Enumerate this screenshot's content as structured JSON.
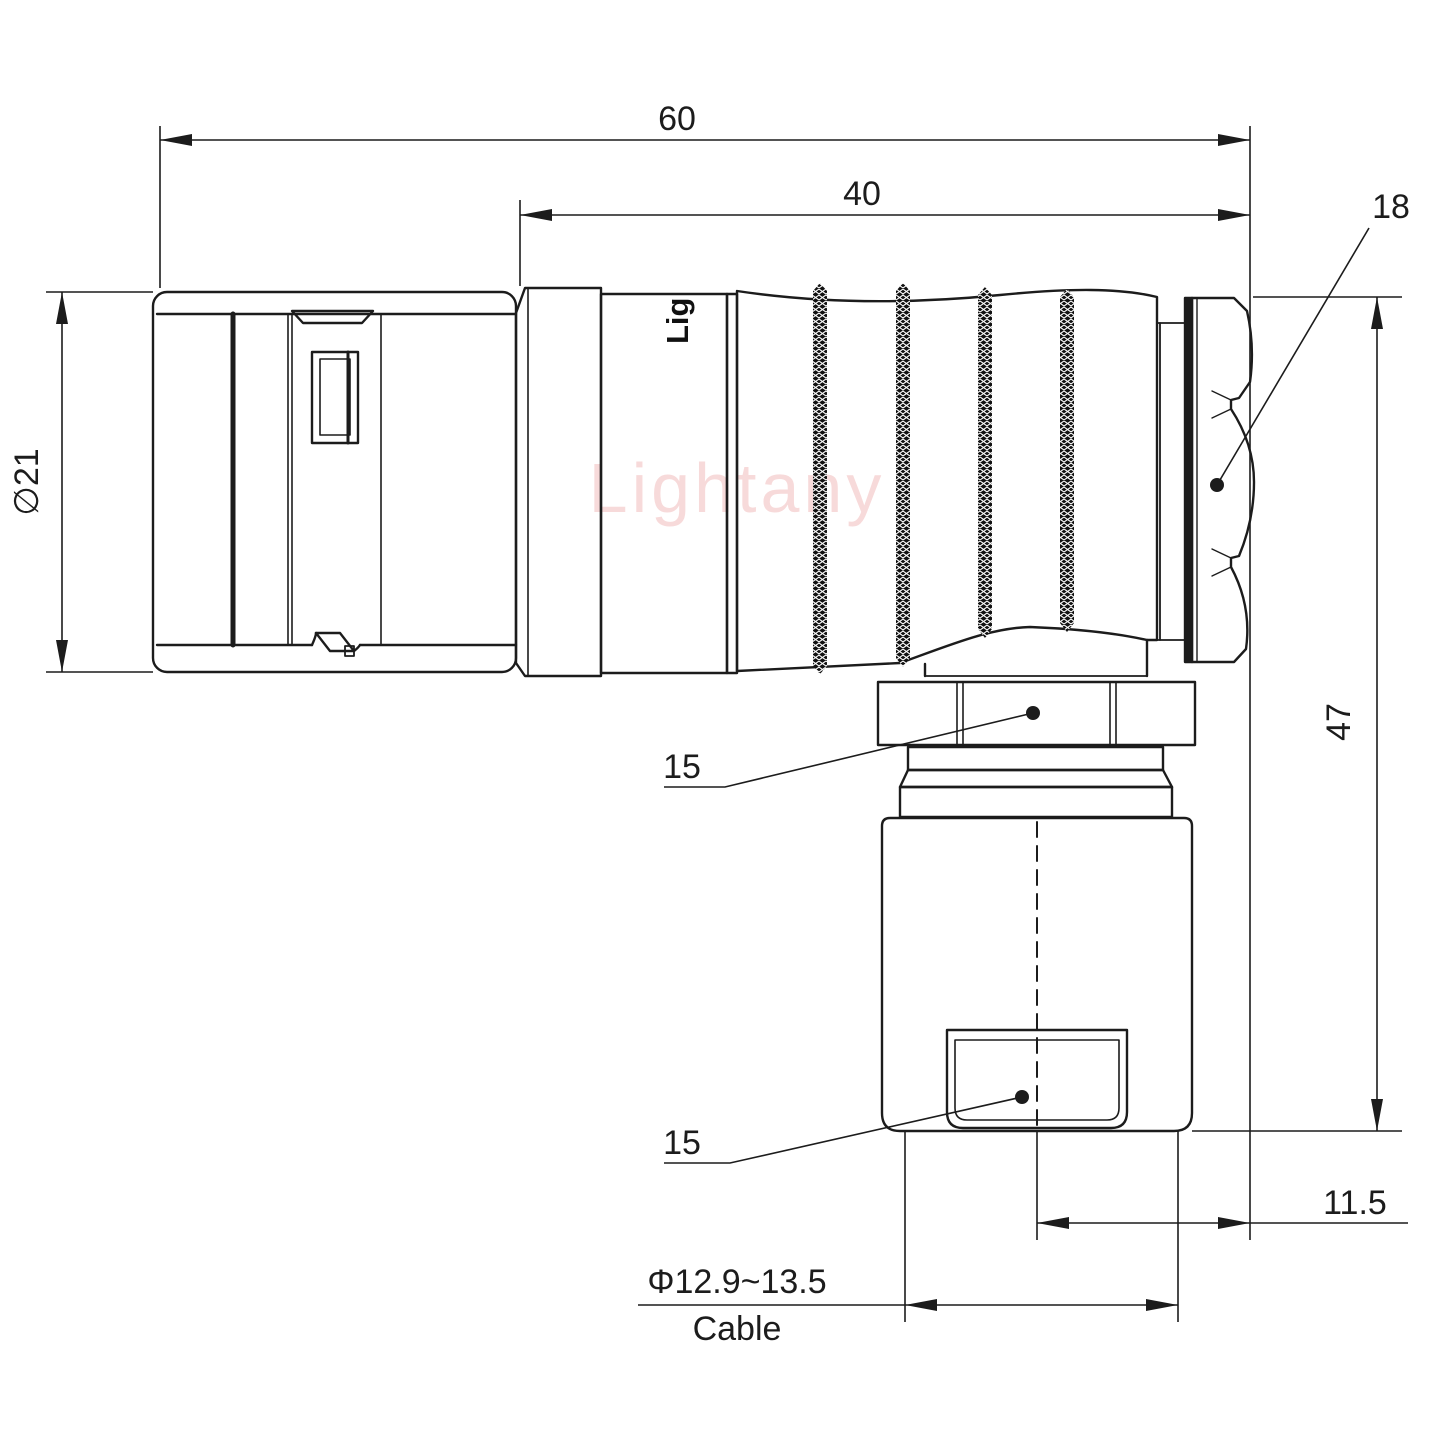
{
  "page": {
    "background": "#ffffff"
  },
  "drawing": {
    "watermark": "Lightany",
    "body_marking": "Lig",
    "line_color": "#1c1c1c",
    "watermark_color": "#f2bcbc",
    "dims": {
      "overall_length": "60",
      "rear_section_length": "40",
      "coupling_nut_af": "18",
      "front_outer_diameter": "∅21",
      "gland_nut_af": "15",
      "cable_clamp_af": "15",
      "overall_height": "47",
      "cable_axis_offset": "11.5",
      "cable_diameter_range": "Φ12.9~13.5",
      "cable_caption": "Cable"
    }
  }
}
